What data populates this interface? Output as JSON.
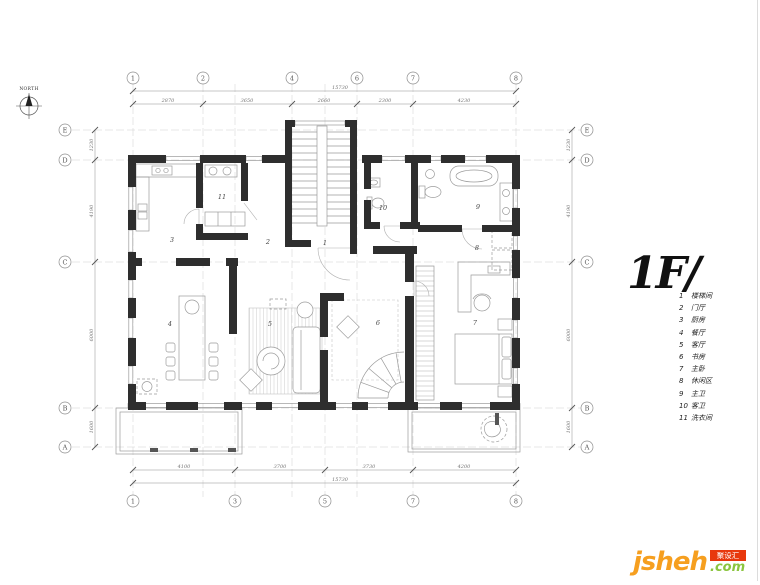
{
  "north": {
    "label": "NORTH"
  },
  "title": {
    "text": "1F/"
  },
  "legend": {
    "items": [
      {
        "num": "1",
        "label": "楼梯间"
      },
      {
        "num": "2",
        "label": "门厅"
      },
      {
        "num": "3",
        "label": "厨房"
      },
      {
        "num": "4",
        "label": "餐厅"
      },
      {
        "num": "5",
        "label": "客厅"
      },
      {
        "num": "6",
        "label": "书房"
      },
      {
        "num": "7",
        "label": "主卧"
      },
      {
        "num": "8",
        "label": "休闲区"
      },
      {
        "num": "9",
        "label": "主卫"
      },
      {
        "num": "10",
        "label": "客卫"
      },
      {
        "num": "11",
        "label": "洗衣间"
      }
    ]
  },
  "grid": {
    "top": [
      "1",
      "2",
      "4",
      "6",
      "7",
      "8"
    ],
    "bottom": [
      "1",
      "3",
      "5",
      "7",
      "8"
    ],
    "left": [
      "E",
      "D",
      "C",
      "B",
      "A"
    ],
    "right": [
      "E",
      "D",
      "C",
      "B",
      "A"
    ]
  },
  "dims": {
    "top_overall": "15730",
    "top_segments": [
      "2870",
      "3650",
      "2660",
      "2300",
      "4230"
    ],
    "bottom_overall": "15730",
    "bottom_segments": [
      "4100",
      "3700",
      "3730",
      "4200"
    ],
    "left_segments": [
      "1230",
      "4190",
      "6000",
      "1600"
    ],
    "right_segments": [
      "1230",
      "4190",
      "6000",
      "1600"
    ]
  },
  "logo": {
    "brand": "jsheh",
    "tld": ".com",
    "badge": "聚设汇"
  },
  "colors": {
    "wall": "#2e2e2e",
    "line": "#9b9b9b",
    "orange": "#f69f1f",
    "green": "#8bc53f",
    "red": "#e8380d"
  }
}
